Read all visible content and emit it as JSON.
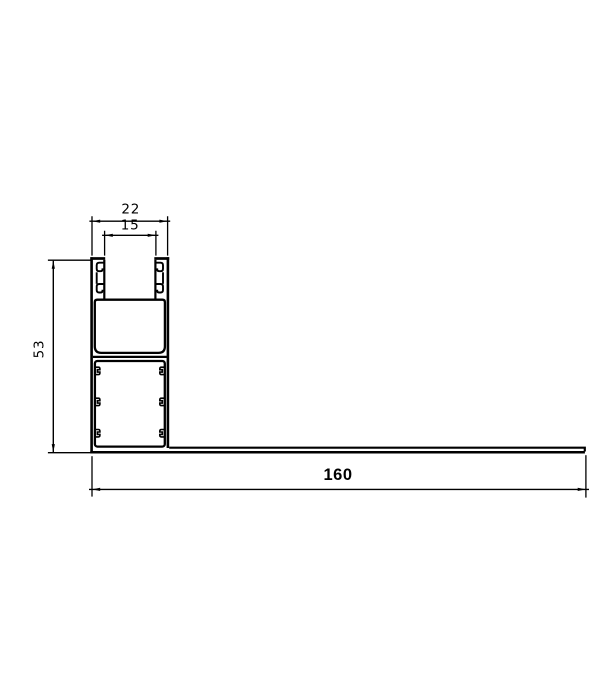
{
  "page": {
    "background": "#ffffff"
  },
  "drawing": {
    "stroke_color": "#000000",
    "dims": {
      "top_width": {
        "value": "22"
      },
      "slot_width": {
        "value": "15"
      },
      "height": {
        "value": "53"
      },
      "base_length": {
        "value": "160"
      }
    }
  }
}
